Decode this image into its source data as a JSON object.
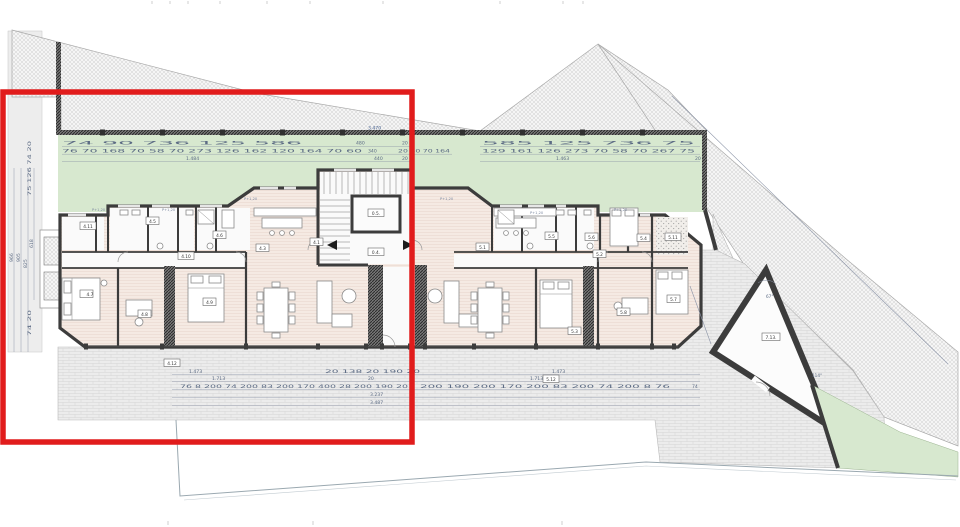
{
  "colors": {
    "highlight": "#e11c1c",
    "terrace_green": "#d7e8cf",
    "floor": "#f5eae3",
    "wall": "#3c3c3c",
    "dim_text": "#5c6b84"
  },
  "labels": {
    "core_upper": "0.5.",
    "core_lower": "0.4.",
    "a4_1": "4.1",
    "a4_3": "4.3",
    "a4_5": "4.5",
    "a4_6": "4.6",
    "a4_7": "4.7",
    "a4_8": "4.8",
    "a4_9": "4.9",
    "a4_10": "4.10",
    "a4_11": "4.11",
    "a4_12": "4.12",
    "a5_1": "5.1",
    "a5_2": "5.2",
    "a5_3": "5.3",
    "a5_4": "5.4",
    "a5_5": "5.5",
    "a5_6": "5.6",
    "a5_7": "5.7",
    "a5_8": "5.8",
    "a5_11": "5.11",
    "a5_12": "5.12",
    "t7_13": "7.13.",
    "angle_top": "67°",
    "angle_bottom": "114°"
  },
  "dims": {
    "top_a_left": "74  90      736      125     586",
    "top_a_mid": "480",
    "top_a_end": "20",
    "top_b_left": "76  70  168  70  58 70   273   126  162  120  164  70 60",
    "top_b_mid": "340",
    "top_b_mid2": "20  40  70  164",
    "top_c_left": "1.484",
    "top_c_mid": "440",
    "top_c_end": "20",
    "top_a_right": "585    125     736     75",
    "top_b_right": "129  161  126  273  70 58 70  267  75",
    "top_c_right": "1.463",
    "top_c_right_end": "20",
    "wall_total": "3.470",
    "lv1": "966",
    "lv2": "905",
    "lv3": "825",
    "lv4": "618",
    "lv_top": "75  126  74  20",
    "lv_bot": "74  20",
    "b1": "1.473",
    "b2": "1.713",
    "b_detail_l": "76 8 200 74 200 83 200 170 400 28 200 190 20",
    "b_mid": "20  138  20 190 20",
    "b_mid2": "20",
    "b3": "3.237",
    "b4": "3.487",
    "b1r": "1.473",
    "b2r": "1.713",
    "b_detail_r": "200 190 200 170 200 83 200 74 200 8 76",
    "b_end": "74",
    "parapet": "P+1,20"
  }
}
